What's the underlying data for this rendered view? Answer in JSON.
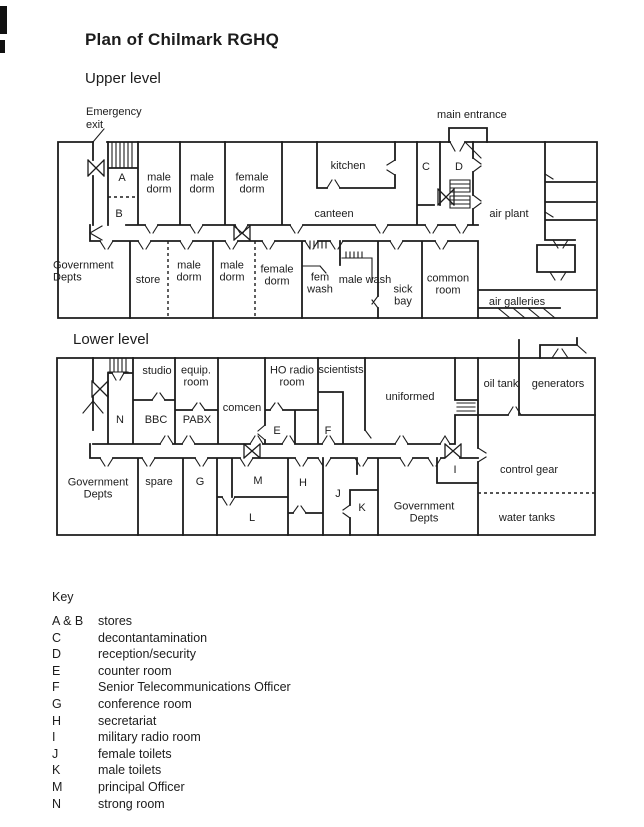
{
  "document": {
    "title": "Plan of Chilmark RGHQ"
  },
  "upper_level": {
    "heading": "Upper level",
    "annotations": {
      "emergency_exit": "Emergency exit",
      "main_entrance": "main entrance"
    },
    "rooms": [
      "A",
      "B",
      "male dorm",
      "male dorm",
      "female dorm",
      "kitchen",
      "canteen",
      "C",
      "D",
      "air plant",
      "Government Depts",
      "store",
      "male dorm",
      "male dorm",
      "female dorm",
      "fem wash",
      "male wash",
      "sick bay",
      "common room",
      "air galleries"
    ]
  },
  "lower_level": {
    "heading": "Lower level",
    "rooms": [
      "N",
      "studio",
      "BBC",
      "equip. room",
      "PABX",
      "comcen",
      "HO radio room",
      "E",
      "scientists",
      "F",
      "uniformed",
      "oil tank",
      "generators",
      "Government Depts",
      "spare",
      "G",
      "M",
      "L",
      "H",
      "J",
      "K",
      "Government Depts",
      "I",
      "control gear",
      "water tanks"
    ]
  },
  "key": {
    "heading": "Key",
    "entries": [
      {
        "code": "A & B",
        "desc": "stores"
      },
      {
        "code": "C",
        "desc": "decontantamination"
      },
      {
        "code": "D",
        "desc": "reception/security"
      },
      {
        "code": "E",
        "desc": "counter room"
      },
      {
        "code": "F",
        "desc": "Senior Telecommunications Officer"
      },
      {
        "code": "G",
        "desc": "conference room"
      },
      {
        "code": "H",
        "desc": "secretariat"
      },
      {
        "code": "I",
        "desc": "military radio room"
      },
      {
        "code": "J",
        "desc": "female toilets"
      },
      {
        "code": "K",
        "desc": "male toilets"
      },
      {
        "code": "M",
        "desc": "principal Officer"
      },
      {
        "code": "N",
        "desc": "strong room"
      }
    ]
  },
  "colors": {
    "ink": "#1c1c1c",
    "paper": "#ffffff"
  }
}
